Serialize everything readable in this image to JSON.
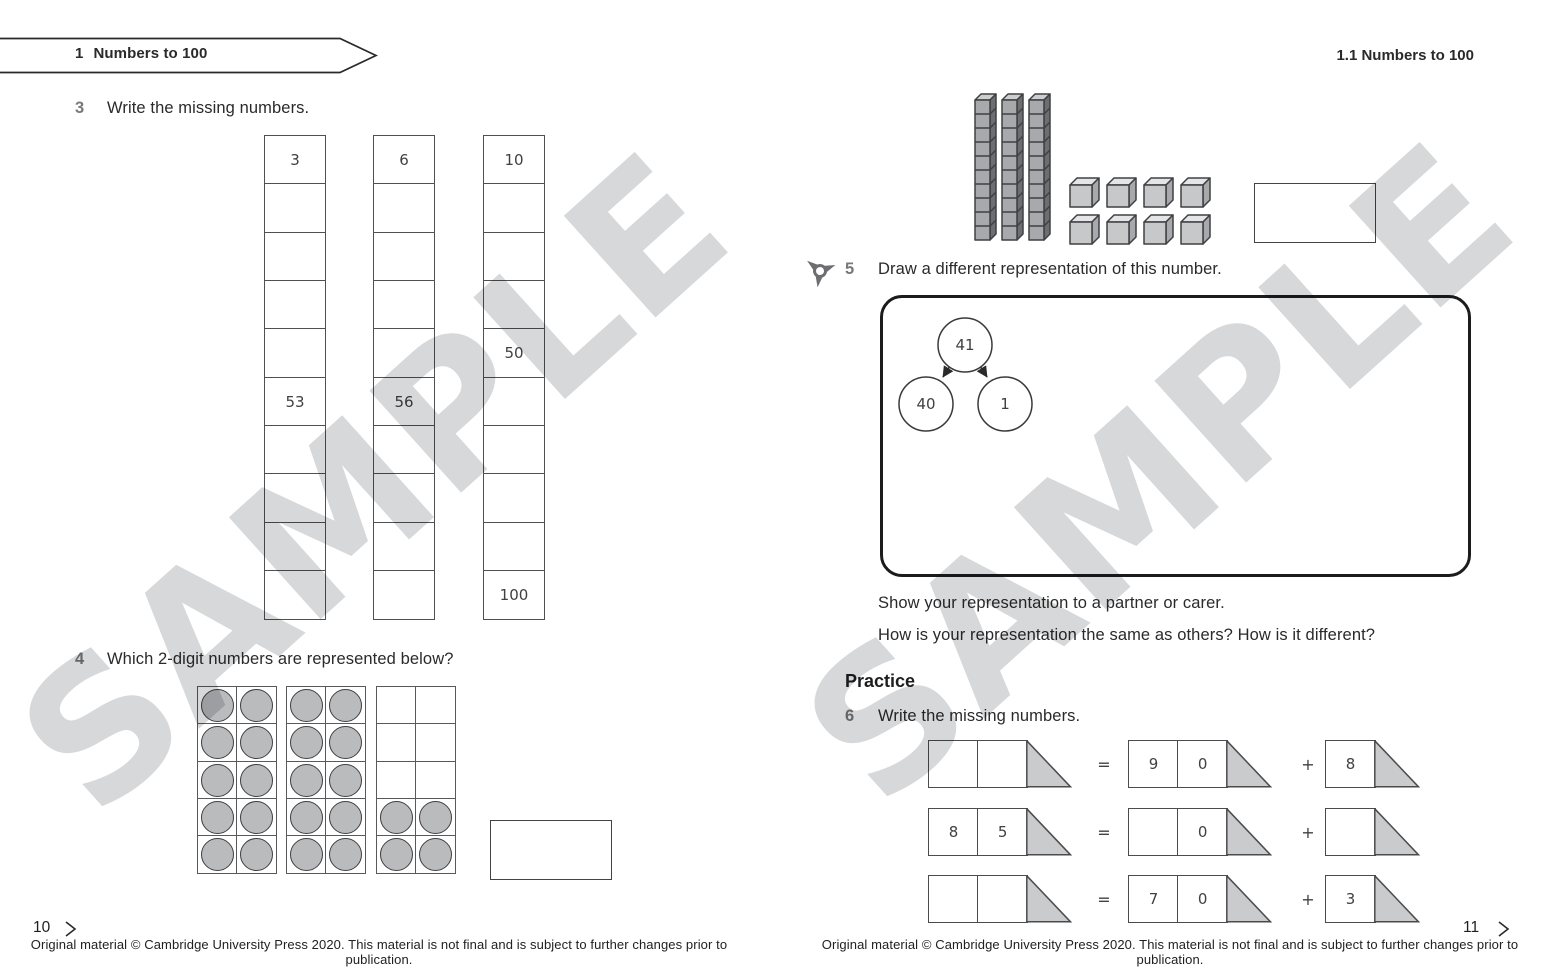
{
  "watermark_text": "SAMPLE",
  "colors": {
    "text_dark": "#2b2a2b",
    "question_number_gray": "#77787b",
    "box_line": "#4f5052",
    "counter_fill": "#b9bbbd",
    "triangle_fill": "#c9cbcd",
    "rod_front": "#a7a9ac",
    "rod_side": "#6d6e71",
    "rod_top": "#cdced0",
    "cube_front": "#c6c8ca",
    "cube_top": "#e4e5e6",
    "cube_side": "#a7a9ac",
    "watermark_gray": "#d7d8d9"
  },
  "left_page": {
    "banner": {
      "number": "1",
      "title": "Numbers to 100"
    },
    "q3": {
      "number": "3",
      "text": "Write the missing numbers."
    },
    "number_columns": [
      {
        "cells": [
          "3",
          "",
          "",
          "",
          "",
          "53",
          "",
          "",
          "",
          ""
        ]
      },
      {
        "cells": [
          "6",
          "",
          "",
          "",
          "",
          "56",
          "",
          "",
          "",
          ""
        ]
      },
      {
        "cells": [
          "10",
          "",
          "",
          "",
          "50",
          "",
          "",
          "",
          "",
          "100"
        ]
      }
    ],
    "q4": {
      "number": "4",
      "text": "Which 2-digit numbers are represented below?"
    },
    "ten_frames": [
      {
        "pattern": [
          1,
          1,
          1,
          1,
          1,
          1,
          1,
          1,
          1,
          1
        ]
      },
      {
        "pattern": [
          1,
          1,
          1,
          1,
          1,
          1,
          1,
          1,
          1,
          1
        ]
      },
      {
        "pattern": [
          0,
          0,
          0,
          0,
          0,
          0,
          1,
          1,
          1,
          1
        ]
      }
    ],
    "page_number": "10",
    "footer": "Original material © Cambridge University Press 2020. This material is not final and is subject to further changes prior to publication."
  },
  "right_page": {
    "header": "1.1  Numbers to 100",
    "base_ten_blocks": {
      "tens": 3,
      "ones": 8
    },
    "q5": {
      "number": "5",
      "text": "Draw a different representation of this number."
    },
    "part_whole": {
      "whole": "41",
      "part_left": "40",
      "part_right": "1"
    },
    "show_line": "Show your representation to a partner or carer.",
    "compare_line": "How is your representation the same as others? How is it different?",
    "practice_heading": "Practice",
    "q6": {
      "number": "6",
      "text": "Write the missing numbers."
    },
    "equations": [
      {
        "left": [
          "",
          ""
        ],
        "equals": "=",
        "middle": [
          "9",
          "0"
        ],
        "plus": "+",
        "right": [
          "8"
        ]
      },
      {
        "left": [
          "8",
          "5"
        ],
        "equals": "=",
        "middle": [
          "",
          "0"
        ],
        "plus": "+",
        "right": [
          ""
        ]
      },
      {
        "left": [
          "",
          ""
        ],
        "equals": "=",
        "middle": [
          "7",
          "0"
        ],
        "plus": "+",
        "right": [
          "3"
        ]
      }
    ],
    "page_number": "11",
    "footer": "Original material © Cambridge University Press 2020. This material is not final and is subject to further changes prior to publication."
  }
}
